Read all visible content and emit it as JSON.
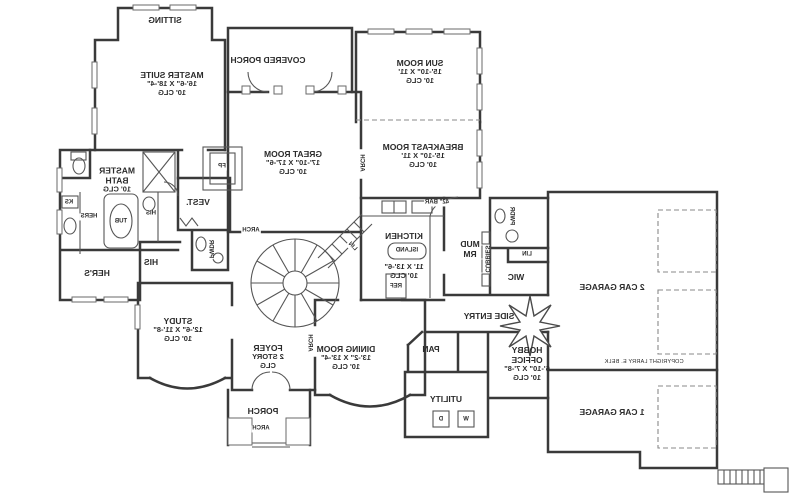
{
  "plan": {
    "style": {
      "ink": "#3a3a3a",
      "paper": "#ffffff"
    },
    "rooms": {
      "sitting": {
        "name": "SITTING"
      },
      "master_suite": {
        "name": "MASTER SUITE",
        "dims": "16'-6\" X 18'-4\"",
        "clg": "10' CLG"
      },
      "covered_porch": {
        "name": "COVERED PORCH"
      },
      "sun_room": {
        "name": "SUN ROOM",
        "dims": "15'-10\" X 11'",
        "clg": "10' CLG"
      },
      "great_room": {
        "name": "GREAT ROOM",
        "dims": "17'-10\" X 17'-6\"",
        "clg": "10' CLG"
      },
      "breakfast_room": {
        "name": "BREAKFAST ROOM",
        "dims": "15'-10\" X 11'",
        "clg": "10' CLG"
      },
      "master_bath": {
        "name": "MASTER BATH",
        "clg": "10' CLG"
      },
      "vestibule": {
        "name": "VEST."
      },
      "kitchen": {
        "name": "KITCHEN",
        "dims": "11' X 13'-6\"",
        "clg": "10' CLG"
      },
      "mud_room": {
        "name": "MUD RM"
      },
      "wic": {
        "name": "WIC"
      },
      "study": {
        "name": "STUDY",
        "dims": "12'-6\" X 11'-8\"",
        "clg": "10' CLG"
      },
      "foyer": {
        "name": "FOYER",
        "dims": "2 STORY",
        "clg": "CLG"
      },
      "dining_room": {
        "name": "DINING ROOM",
        "dims": "13'-2\" X 13'-4\"",
        "clg": "10' CLG"
      },
      "side_entry": {
        "name": "SIDE ENTRY"
      },
      "utility": {
        "name": "UTILITY"
      },
      "pantry": {
        "name": "PAN"
      },
      "hobby_office": {
        "name": "HOBBY OFFICE",
        "dims": "6'-10\" X 7'-8\"",
        "clg": "10' CLG"
      },
      "two_car_garage": {
        "name": "2 CAR GARAGE"
      },
      "one_car_garage": {
        "name": "1 CAR GARAGE"
      },
      "porch": {
        "name": "PORCH"
      },
      "hers_closet": {
        "name": "HER'S"
      },
      "his_closet": {
        "name": "HIS"
      }
    },
    "annotations": {
      "tub": "TUB",
      "hers_vanity": "HERS",
      "his_vanity": "HIS",
      "knee_space": "KS",
      "fireplace": "FP",
      "island": "ISLAND",
      "refrigerator": "REF",
      "bar": "42\" BAR",
      "linen_stair": "LIN",
      "linen_mud": "LIN",
      "cubbies": "CUBBIES",
      "powder_hall": "PWDR",
      "powder_mud": "PWDR",
      "arch_hall": "ARCH",
      "arch_breakfast": "ARCH",
      "arch_dining": "ARCH",
      "arch_porch": "ARCH",
      "washer": "W",
      "dryer": "D",
      "copyright": "COPYRIGHT LARRY E. BELK"
    }
  }
}
